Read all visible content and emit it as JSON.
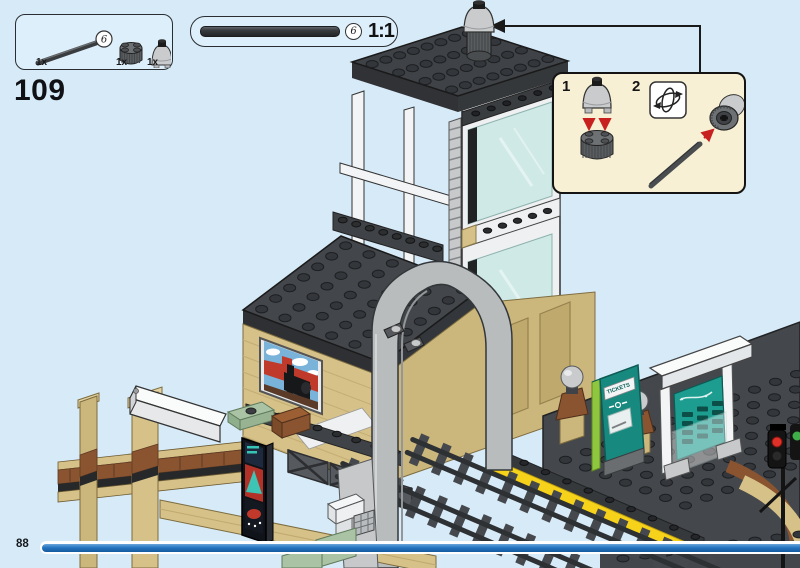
{
  "colors": {
    "background": "#d6eaf7",
    "panel_fill": "#ddeffb",
    "panel_border": "#2a2e33",
    "subassembly_fill": "#f7f0d5",
    "progress_blue": "#2674c0",
    "arrow_red": "#c8201f",
    "brick_tan": "#d6c188",
    "roof_gray": "#44474b",
    "arch_gray": "#b9bcbd",
    "glass_teal": "#cfe9e6",
    "machine_teal": "#17897f",
    "machine_lime": "#8fc63f",
    "platform_yellow": "#f6d21a"
  },
  "step": {
    "number": "109"
  },
  "parts_box": {
    "parts": [
      {
        "count": "1x",
        "name": "technic-axle-black",
        "callout": "6"
      },
      {
        "count": "1x",
        "name": "round-brick-2x2-dark-gray"
      },
      {
        "count": "1x",
        "name": "dome-brick-2x2-light-gray"
      }
    ]
  },
  "scale_box": {
    "callout": "6",
    "label": "1:1",
    "part": "technic-axle-black"
  },
  "subassembly": {
    "steps": [
      {
        "number": "1"
      },
      {
        "number": "2",
        "icon": "rotate-3d-icon"
      }
    ]
  },
  "model": {
    "ticket_machine_label": "TICKETS"
  },
  "footer": {
    "page_number": "88"
  }
}
